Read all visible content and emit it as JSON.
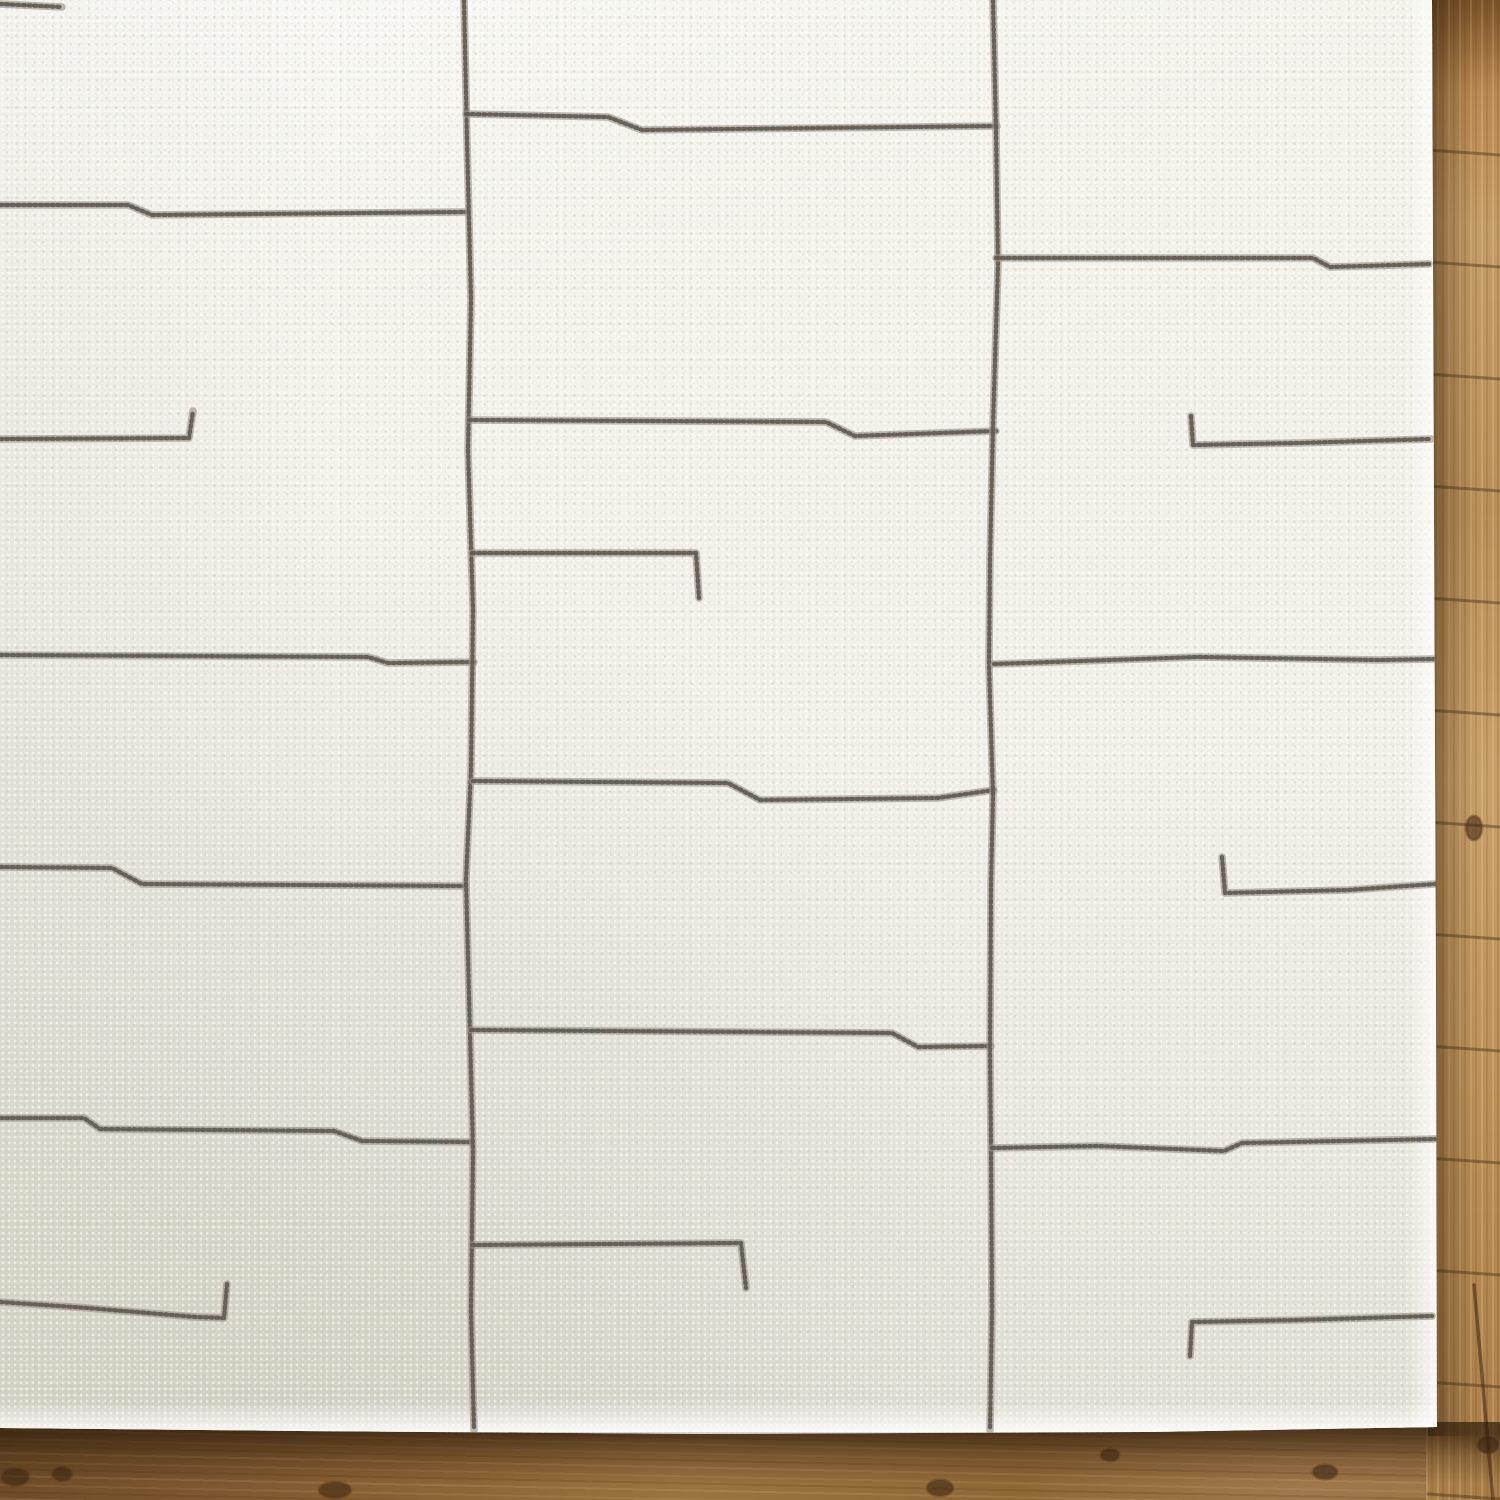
{
  "scene": {
    "description": "Overhead corner view of an ivory hand-tufted area rug with thin irregular gray abstract lines, lying on a warm oak plank floor; wood visible as a narrow strip on the right and along the bottom, with soft shadow under the rug edges.",
    "palette": {
      "rug_ivory": "#f1f0e8",
      "rug_shade": "#d9d6c6",
      "line_gray_dark": "#5f5a50",
      "line_gray_light": "#9a948a",
      "wood_light": "#c59c66",
      "wood_mid": "#9c7342",
      "wood_dark": "#6e4c28",
      "wood_seam": "#4e3418",
      "shadow_brown": "#2f1d0b"
    }
  },
  "rug": {
    "outline_px": [
      [
        0,
        0
      ],
      [
        1432,
        0
      ],
      [
        1434,
        520
      ],
      [
        1436,
        1000
      ],
      [
        1437,
        1427
      ],
      [
        1150,
        1432
      ],
      [
        700,
        1434
      ],
      [
        300,
        1431
      ],
      [
        0,
        1428
      ]
    ],
    "pattern_lines": [
      {
        "name": "top-left-stub",
        "points": [
          [
            0,
            4
          ],
          [
            62,
            7
          ]
        ]
      },
      {
        "name": "left-line-1",
        "points": [
          [
            0,
            205
          ],
          [
            128,
            205
          ],
          [
            152,
            215
          ],
          [
            466,
            212
          ]
        ]
      },
      {
        "name": "left-hook-1",
        "points": [
          [
            0,
            439
          ],
          [
            189,
            438
          ],
          [
            193,
            411
          ]
        ]
      },
      {
        "name": "left-line-2",
        "points": [
          [
            0,
            655
          ],
          [
            368,
            657
          ],
          [
            388,
            663
          ],
          [
            474,
            662
          ]
        ]
      },
      {
        "name": "left-line-3",
        "points": [
          [
            0,
            867
          ],
          [
            112,
            868
          ],
          [
            142,
            884
          ],
          [
            464,
            886
          ]
        ]
      },
      {
        "name": "left-line-4",
        "points": [
          [
            0,
            1118
          ],
          [
            84,
            1118
          ],
          [
            100,
            1129
          ],
          [
            334,
            1131
          ],
          [
            362,
            1141
          ],
          [
            471,
            1142
          ]
        ]
      },
      {
        "name": "left-hook-2",
        "points": [
          [
            0,
            1302
          ],
          [
            88,
            1308
          ],
          [
            196,
            1317
          ],
          [
            224,
            1318
          ],
          [
            227,
            1284
          ]
        ]
      },
      {
        "name": "mid-vertical-1",
        "points": [
          [
            464,
            0
          ],
          [
            467,
            140
          ],
          [
            471,
            300
          ],
          [
            468,
            450
          ],
          [
            473,
            610
          ],
          [
            471,
            770
          ],
          [
            466,
            880
          ],
          [
            470,
            1035
          ],
          [
            473,
            1150
          ],
          [
            471,
            1310
          ],
          [
            474,
            1430
          ]
        ]
      },
      {
        "name": "mid-line-1",
        "points": [
          [
            466,
            114
          ],
          [
            608,
            117
          ],
          [
            642,
            130
          ],
          [
            997,
            126
          ]
        ]
      },
      {
        "name": "mid-line-2",
        "points": [
          [
            469,
            420
          ],
          [
            826,
            422
          ],
          [
            855,
            436
          ],
          [
            996,
            431
          ]
        ]
      },
      {
        "name": "mid-hook-1",
        "points": [
          [
            472,
            553
          ],
          [
            696,
            553
          ],
          [
            699,
            598
          ]
        ]
      },
      {
        "name": "mid-line-3",
        "points": [
          [
            473,
            781
          ],
          [
            728,
            783
          ],
          [
            760,
            800
          ],
          [
            938,
            798
          ],
          [
            994,
            790
          ]
        ]
      },
      {
        "name": "mid-line-4",
        "points": [
          [
            471,
            1030
          ],
          [
            892,
            1033
          ],
          [
            918,
            1047
          ],
          [
            991,
            1046
          ]
        ]
      },
      {
        "name": "mid-hook-2",
        "points": [
          [
            472,
            1245
          ],
          [
            741,
            1243
          ],
          [
            746,
            1288
          ]
        ]
      },
      {
        "name": "mid-vertical-2",
        "points": [
          [
            993,
            0
          ],
          [
            996,
            130
          ],
          [
            998,
            265
          ],
          [
            993,
            425
          ],
          [
            990,
            560
          ],
          [
            989,
            665
          ],
          [
            993,
            795
          ],
          [
            991,
            885
          ],
          [
            990,
            1050
          ],
          [
            991,
            1150
          ],
          [
            992,
            1310
          ],
          [
            990,
            1430
          ]
        ]
      },
      {
        "name": "right-line-1",
        "points": [
          [
            996,
            258
          ],
          [
            1313,
            258
          ],
          [
            1330,
            267
          ],
          [
            1429,
            264
          ]
        ]
      },
      {
        "name": "right-hook-1",
        "points": [
          [
            1191,
            416
          ],
          [
            1193,
            445
          ],
          [
            1299,
            443
          ],
          [
            1431,
            439
          ]
        ]
      },
      {
        "name": "right-line-2",
        "points": [
          [
            994,
            664
          ],
          [
            1198,
            657
          ],
          [
            1378,
            660
          ],
          [
            1437,
            659
          ]
        ]
      },
      {
        "name": "right-hook-2",
        "points": [
          [
            1222,
            857
          ],
          [
            1225,
            893
          ],
          [
            1348,
            890
          ],
          [
            1435,
            884
          ]
        ]
      },
      {
        "name": "right-line-3",
        "points": [
          [
            992,
            1148
          ],
          [
            1098,
            1146
          ],
          [
            1224,
            1151
          ],
          [
            1242,
            1143
          ],
          [
            1437,
            1139
          ]
        ]
      },
      {
        "name": "right-hook-3",
        "points": [
          [
            1190,
            1356
          ],
          [
            1192,
            1322
          ],
          [
            1298,
            1320
          ],
          [
            1432,
            1316
          ]
        ]
      }
    ]
  },
  "floor": {
    "right_strip": {
      "x": 1428,
      "first_seam_y": 150,
      "seam_spacing": 112,
      "seam_slope": 5
    },
    "butt_joints": [
      [
        [
          1474,
          1285
        ],
        [
          1493,
          1500
        ]
      ]
    ],
    "knots": [
      [
        15,
        1477,
        14,
        9
      ],
      [
        62,
        1474,
        10,
        7
      ],
      [
        335,
        1490,
        16,
        8
      ],
      [
        940,
        1488,
        13,
        8
      ],
      [
        1110,
        1455,
        9,
        6
      ],
      [
        1325,
        1472,
        12,
        7
      ],
      [
        1474,
        828,
        8,
        12
      ],
      [
        1488,
        1445,
        10,
        8
      ]
    ]
  }
}
